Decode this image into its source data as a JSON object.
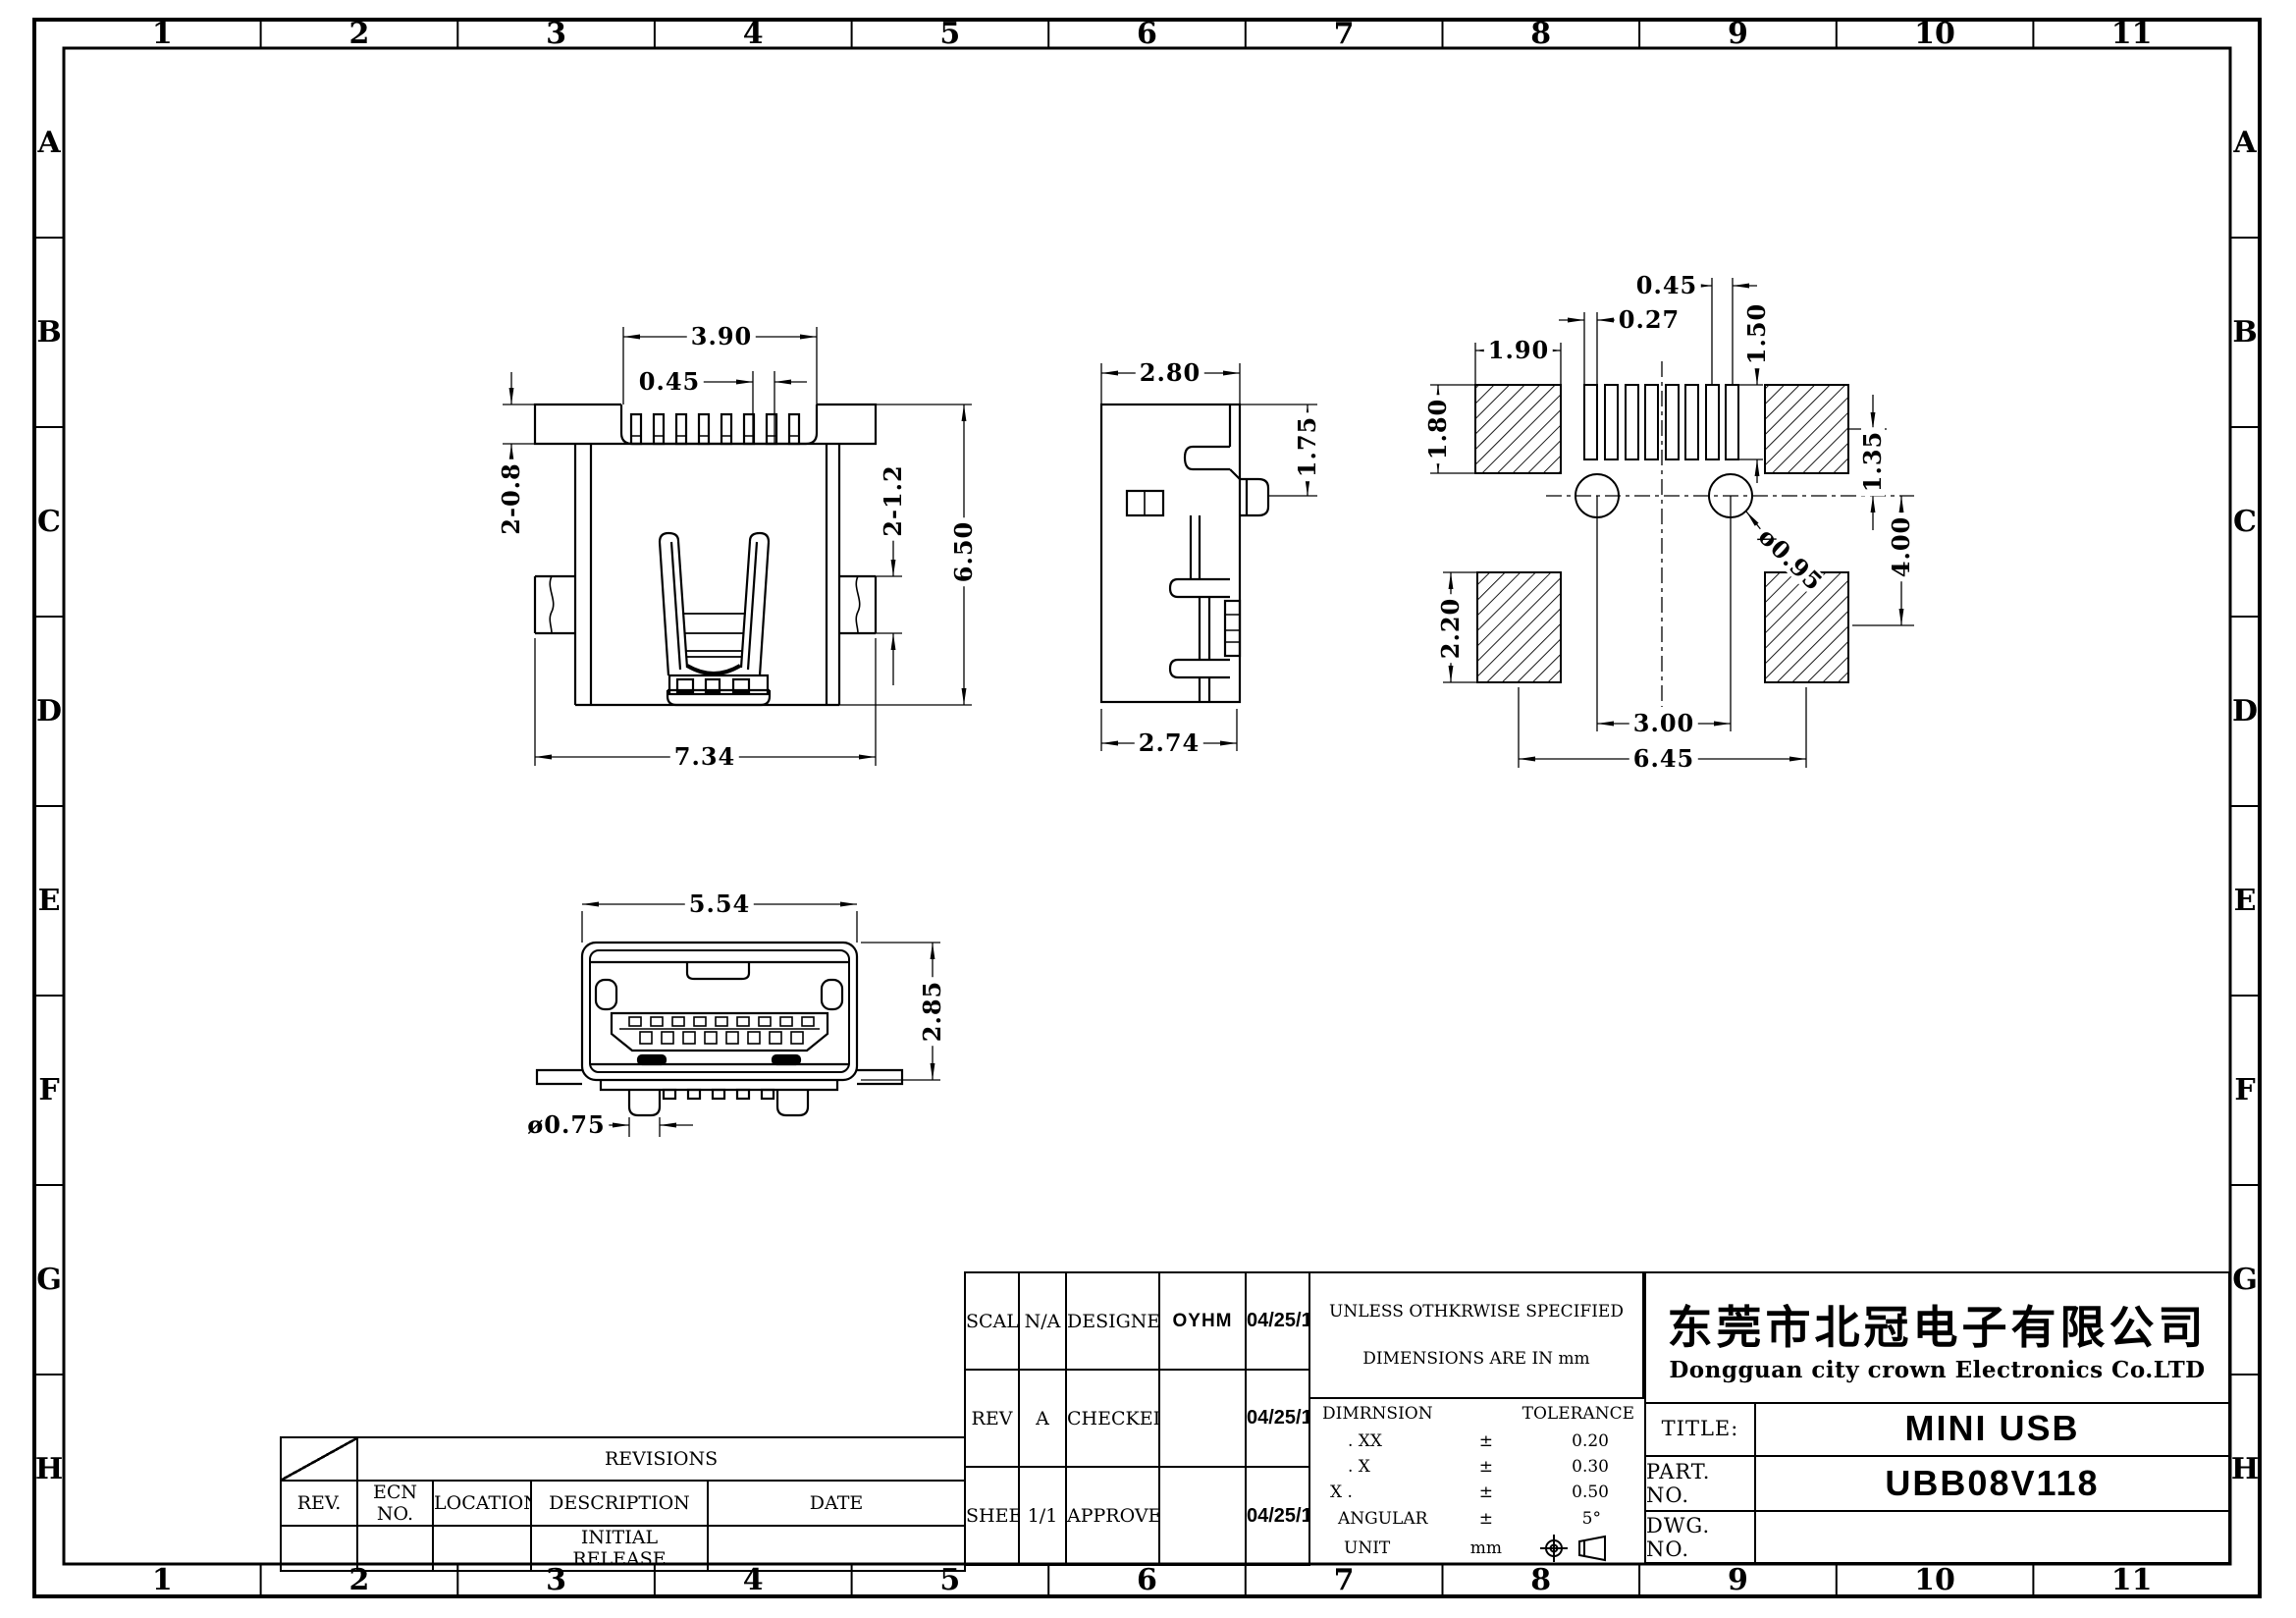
{
  "grid": {
    "columns": [
      "1",
      "2",
      "3",
      "4",
      "5",
      "6",
      "7",
      "8",
      "9",
      "10",
      "11"
    ],
    "rows": [
      "A",
      "B",
      "C",
      "D",
      "E",
      "F",
      "G",
      "H"
    ]
  },
  "views": {
    "top_view": {
      "dim_width_top": "3.90",
      "dim_pin_pitch": "0.45",
      "dim_slot_left": "2-0.8",
      "dim_slot_right": "2-1.2",
      "dim_height": "6.50",
      "dim_width_bottom": "7.34"
    },
    "side_view": {
      "dim_width_top": "2.80",
      "dim_pin_height": "1.75",
      "dim_width_bottom": "2.74"
    },
    "footprint_view": {
      "dim_pad_pitch": "0.45",
      "dim_slot_width": "0.27",
      "dim_pad_width": "1.90",
      "dim_slot_length": "1.50",
      "dim_pad_height": "1.80",
      "dim_hole_offset": "1.35",
      "dim_span_vertical": "4.00",
      "dim_hole_dia": "ø0.95",
      "dim_pad2_height": "2.20",
      "dim_hole_pitch": "3.00",
      "dim_pad_span": "6.45"
    },
    "front_view": {
      "dim_width": "5.54",
      "dim_height": "2.85",
      "dim_leg_dia": "ø0.75"
    }
  },
  "revisions": {
    "title": "REVISIONS",
    "headers": [
      "REV.",
      "ECN NO.",
      "LOCATION",
      "DESCRIPTION",
      "DATE"
    ],
    "row": {
      "rev": "",
      "ecn": "",
      "location": "",
      "description": "INITIAL RELEASE",
      "date": ""
    }
  },
  "title_block": {
    "scale_label": "SCALE",
    "scale_value": "N/A",
    "designer_label": "DESIGNER",
    "designer_value": "OYHM",
    "designer_date": "04/25/11",
    "rev_label": "REV",
    "rev_value": "A",
    "checked_label": "CHECKED",
    "checked_value": "",
    "checked_date": "04/25/11",
    "sheet_label": "SHEET",
    "sheet_value": "1/1",
    "approve_label": "APPROVE",
    "approve_value": "",
    "approve_date": "04/25/11",
    "spec_note_1": "UNLESS OTHKRWISE SPECIFIED",
    "spec_note_2": "DIMENSIONS ARE IN mm",
    "tol_dim_header": "DIMRNSION",
    "tol_tol_header": "TOLERANCE",
    "tol_rows": [
      {
        "dim": ". XX",
        "sign": "±",
        "value": "0.20"
      },
      {
        "dim": ". X",
        "sign": "±",
        "value": "0.30"
      },
      {
        "dim": "X .",
        "sign": "±",
        "value": "0.50"
      },
      {
        "dim": "ANGULAR",
        "sign": "±",
        "value": "5°"
      },
      {
        "dim": "UNIT",
        "sign": "mm",
        "value": ""
      }
    ],
    "company_cn": "东莞市北冠电子有限公司",
    "company_en": "Dongguan city crown Electronics Co.LTD",
    "title_label": "TITLE:",
    "title_value": "MINI USB",
    "part_label": "PART. NO.",
    "part_value": "UBB08V118",
    "dwg_label": "DWG. NO.",
    "dwg_value": ""
  }
}
